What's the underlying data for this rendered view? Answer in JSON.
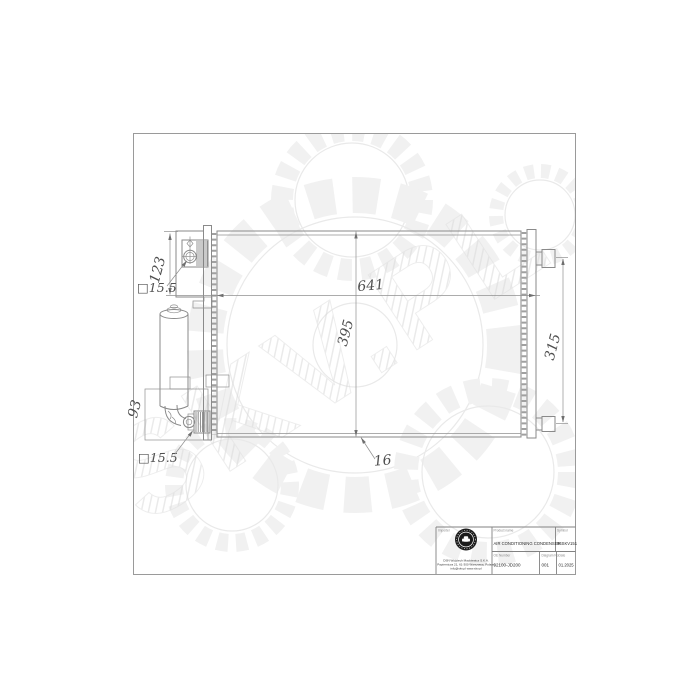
{
  "watermark": {
    "text": "SKV.PL"
  },
  "drawing": {
    "dims": {
      "overall_width": "641",
      "core_height": "395",
      "bracket_spacing": "315",
      "inlet_offset": "123",
      "outlet_offset": "93",
      "depth": "16",
      "inlet_port": "□15.5",
      "outlet_port": "□15.5"
    }
  },
  "title_block": {
    "importer_label": "Importer",
    "product_label": "Product name",
    "product_name": "AIR CONDITIONING CONDENSER",
    "symbol_label": "Symbol",
    "symbol_value": "94SKV151",
    "oe_label": "OE Number",
    "oe_value": "92100-JD200",
    "diagram_label": "Diagram No.",
    "diagram_value": "001",
    "date_label": "Date",
    "date_value": "01.2025",
    "company_line1": "DSN Wojciech Mackiewicz S.K.A.",
    "company_line2": "Papiernicza 21, 61-300 Warszawa, Poland",
    "company_line3": "info@skv.pl  www.skv.pl"
  },
  "colors": {
    "line": "#8a8a8a",
    "dim_text": "#4f4f4f",
    "frame": "#9a9a9a",
    "watermark": "#e8e8e8"
  }
}
